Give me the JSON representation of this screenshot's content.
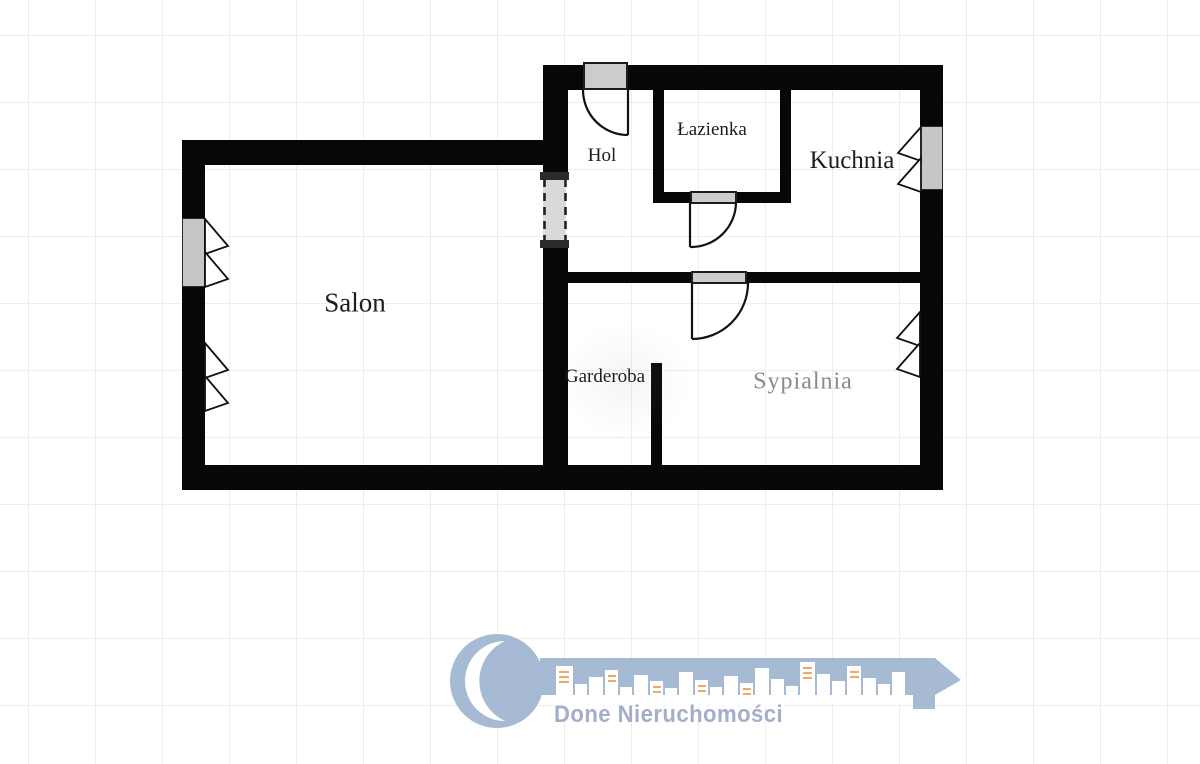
{
  "plan_type": "apartment-floor-plan",
  "rooms": {
    "hol": {
      "label": "Hol"
    },
    "lazienka": {
      "label": "Łazienka"
    },
    "kuchnia": {
      "label": "Kuchnia"
    },
    "salon": {
      "label": "Salon"
    },
    "garderoba": {
      "label": "Garderoba"
    },
    "sypialnia": {
      "label": "Sypialnia"
    }
  },
  "branding": {
    "company": "Done Nieruchomości"
  },
  "colors": {
    "wall": "#070707",
    "door_window_fill": "#cccccc",
    "passage_fill": "#d9d9d9",
    "logo_key": "#a7bad3",
    "logo_text": "#a4adca",
    "building_windows": "#e6a04a",
    "faded_room_label": "#5d5d5d",
    "grid_line": "#f1ebeb"
  }
}
